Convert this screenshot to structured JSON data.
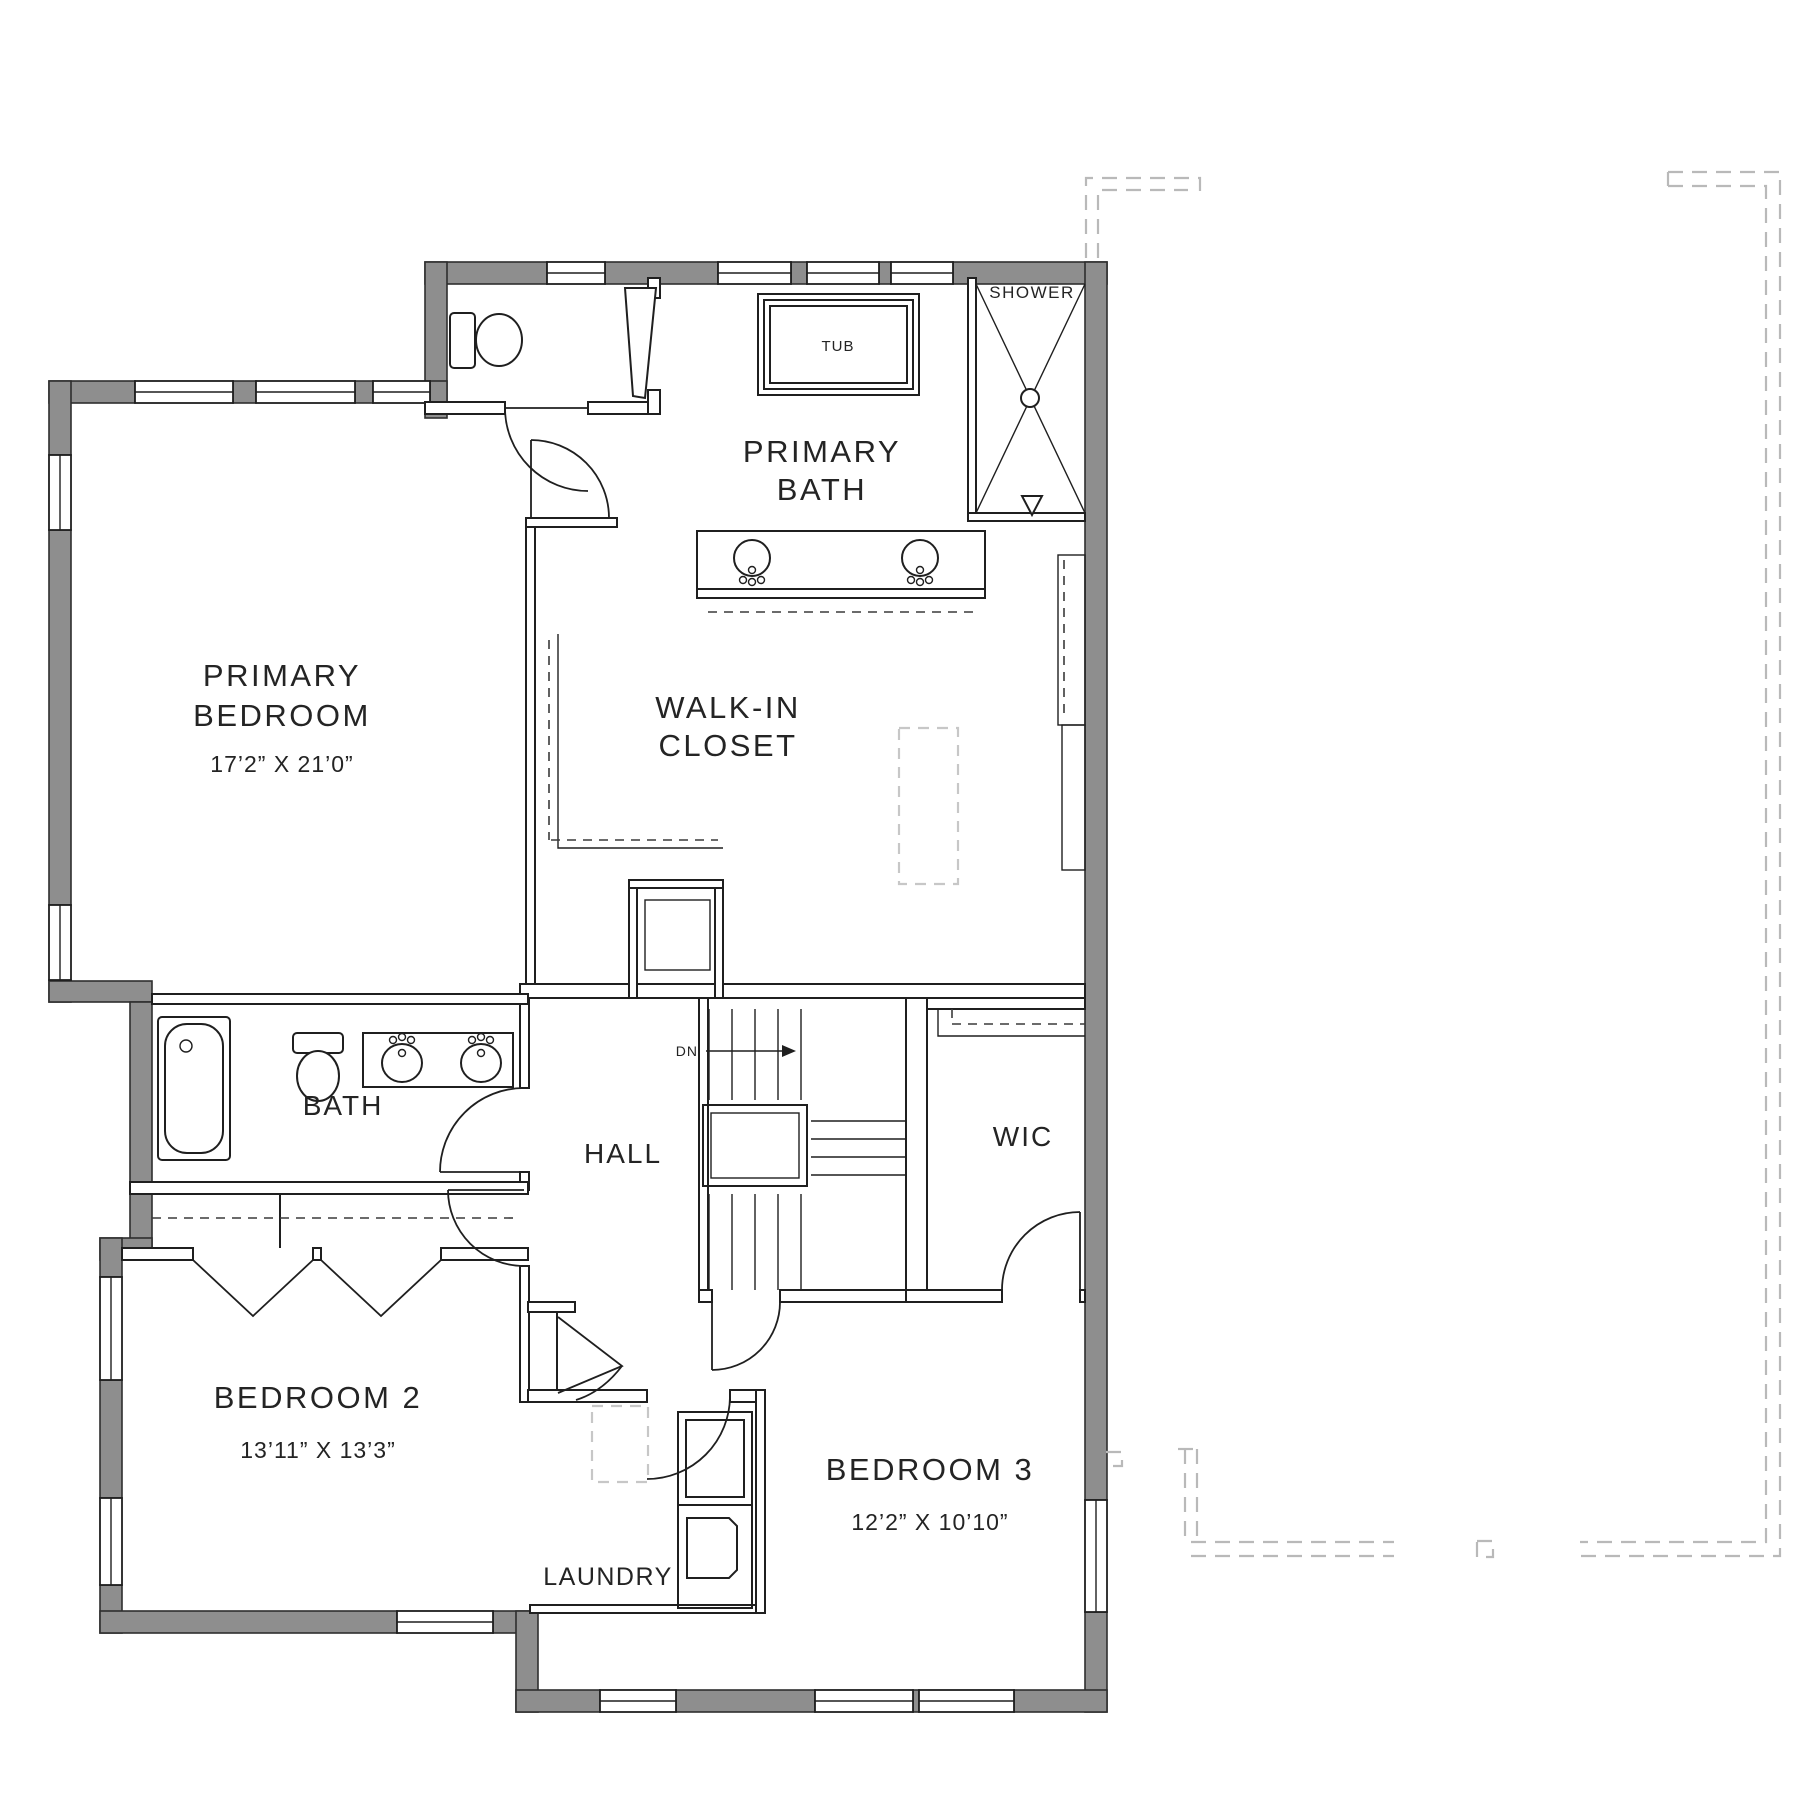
{
  "plan": {
    "title": "Second Floor Plan",
    "colors": {
      "wall_gray": "#8E8E8E",
      "line_black": "#1F1F1F",
      "adjacent_dashed_gray": "#B9B9B9"
    },
    "rooms": {
      "primary_bedroom": {
        "line1": "PRIMARY",
        "line2": "BEDROOM",
        "dims": "17’2” X 21’0”"
      },
      "primary_bath": {
        "line1": "PRIMARY",
        "line2": "BATH"
      },
      "walk_in_closet": {
        "line1": "WALK-IN",
        "line2": "CLOSET"
      },
      "bath": {
        "label": "BATH"
      },
      "hall": {
        "label": "HALL"
      },
      "wic": {
        "label": "WIC"
      },
      "bedroom_2": {
        "label": "BEDROOM 2",
        "dims": "13’11” X 13’3”"
      },
      "bedroom_3": {
        "label": "BEDROOM 3",
        "dims": "12’2” X 10’10”"
      },
      "laundry": {
        "label": "LAUNDRY"
      }
    },
    "fixtures": {
      "tub": "TUB",
      "shower": "SHOWER",
      "stairs_down": "DN"
    }
  }
}
